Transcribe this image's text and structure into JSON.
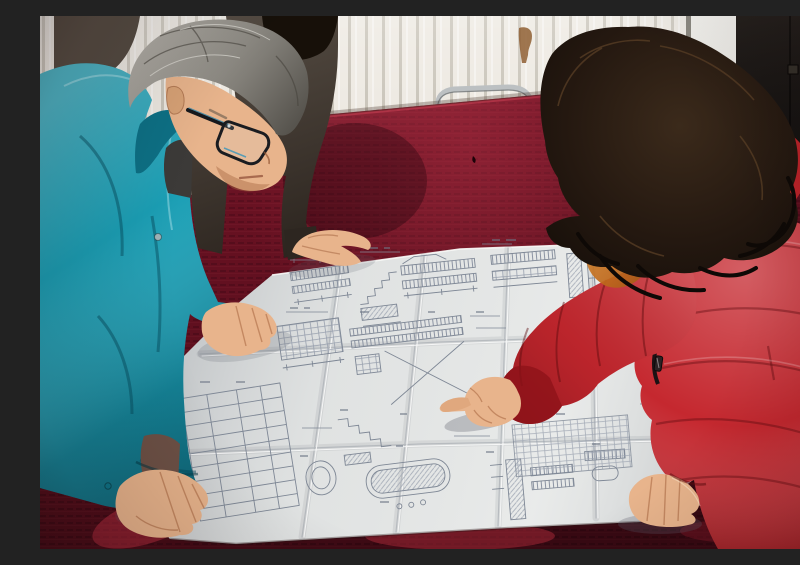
{
  "scene": {
    "label": "Blueprint review photo",
    "description": "Indoor photograph: a gray-haired man wearing glasses and a teal work jacket leans over a large unfolded engineering blueprint spread on a table draped in dark red crushed velvet, while a woman in a bright red down coat with an orange fur-trimmed hood points at a detail on the drawing with her right index finger and rests her left hand on the sheet. A third person in a dark jacket, mostly hidden behind the man, rests one hand on the top edge of the drawing. Background: cream wall with a vertical-fin radiator on the left, a light door frame strip, and a dark door on the right. A chrome-framed chair with a red back peeks above the far edge of the table.",
    "objects": [
      "gray-haired-man-in-teal-jacket",
      "eyeglasses",
      "woman-in-red-fur-trimmed-coat",
      "third-person-dark-jacket",
      "engineering-blueprint-with-fold-creases",
      "red-velvet-tablecloth",
      "radiator-wall",
      "door-frame-strip",
      "dark-door",
      "chrome-chair-back",
      "wall-stain"
    ],
    "blueprint": {
      "content": "dense illegible technical linework: elevation bars, stair sections, dimension lines, schedule tables, oval duct details",
      "folds": "creased into a grid of panels"
    }
  },
  "colors": {
    "wall": "#eae5dc",
    "radiator-line": "#b9b1a0",
    "door": "#141110",
    "door-frame": "#d6d3cc",
    "tablecloth": "#641020",
    "tablecloth-highlight": "#a12a3a",
    "paper": "#e6e8e7",
    "blueprint-ink": "#7e8795",
    "jacket-teal": "#1b9fb5",
    "jacket-teal-dark": "#0b6a80",
    "coat-red": "#c5282f",
    "coat-red-dark": "#8c151b",
    "fur-orange": "#c06a1c",
    "hair-gray": "#8d8a83",
    "hair-dark-brown": "#241810",
    "hair-black": "#171009",
    "skin": "#e8b48c",
    "skin-shadow": "#bf8a5f",
    "chair-red": "#a31c26",
    "chrome": "#bcc0c2"
  }
}
